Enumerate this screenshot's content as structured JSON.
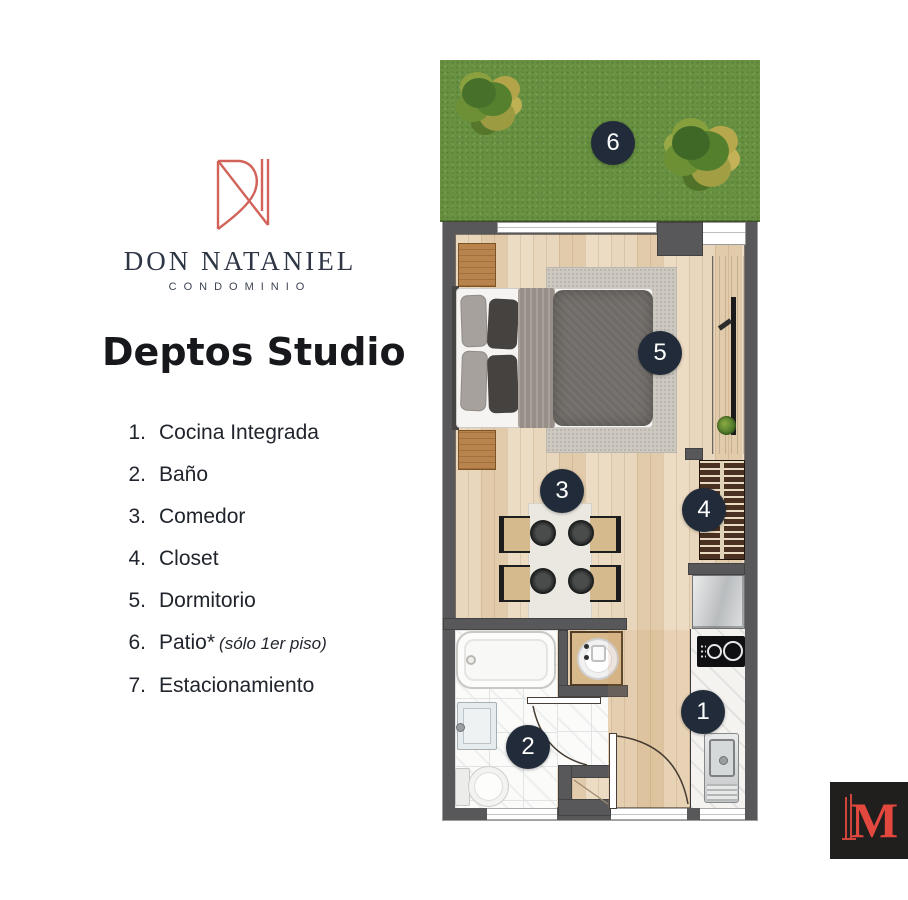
{
  "brand": {
    "name": "DON NATANIEL",
    "subtitle": "CONDOMINIO",
    "monogram": "DN-monogram",
    "accent_color": "#d2635b",
    "text_color": "#2e3545"
  },
  "title": "Deptos Studio",
  "legend": {
    "items": [
      {
        "num": "1.",
        "label": "Cocina Integrada"
      },
      {
        "num": "2.",
        "label": "Baño"
      },
      {
        "num": "3.",
        "label": "Comedor"
      },
      {
        "num": "4.",
        "label": "Closet"
      },
      {
        "num": "5.",
        "label": "Dormitorio"
      },
      {
        "num": "6.",
        "label": "Patio*",
        "note": "(sólo 1er piso)"
      },
      {
        "num": "7.",
        "label": "Estacionamiento"
      }
    ]
  },
  "floorplan": {
    "markers": [
      {
        "id": "1"
      },
      {
        "id": "2"
      },
      {
        "id": "3"
      },
      {
        "id": "4"
      },
      {
        "id": "5"
      },
      {
        "id": "6"
      }
    ],
    "marker_color": "#212b39",
    "grass_color": "#679140",
    "wall_color": "#58585a",
    "wood_color": "#e8d5bb"
  },
  "watermark": {
    "letter": "M",
    "bg": "#211e1e",
    "color": "#e2483e"
  }
}
